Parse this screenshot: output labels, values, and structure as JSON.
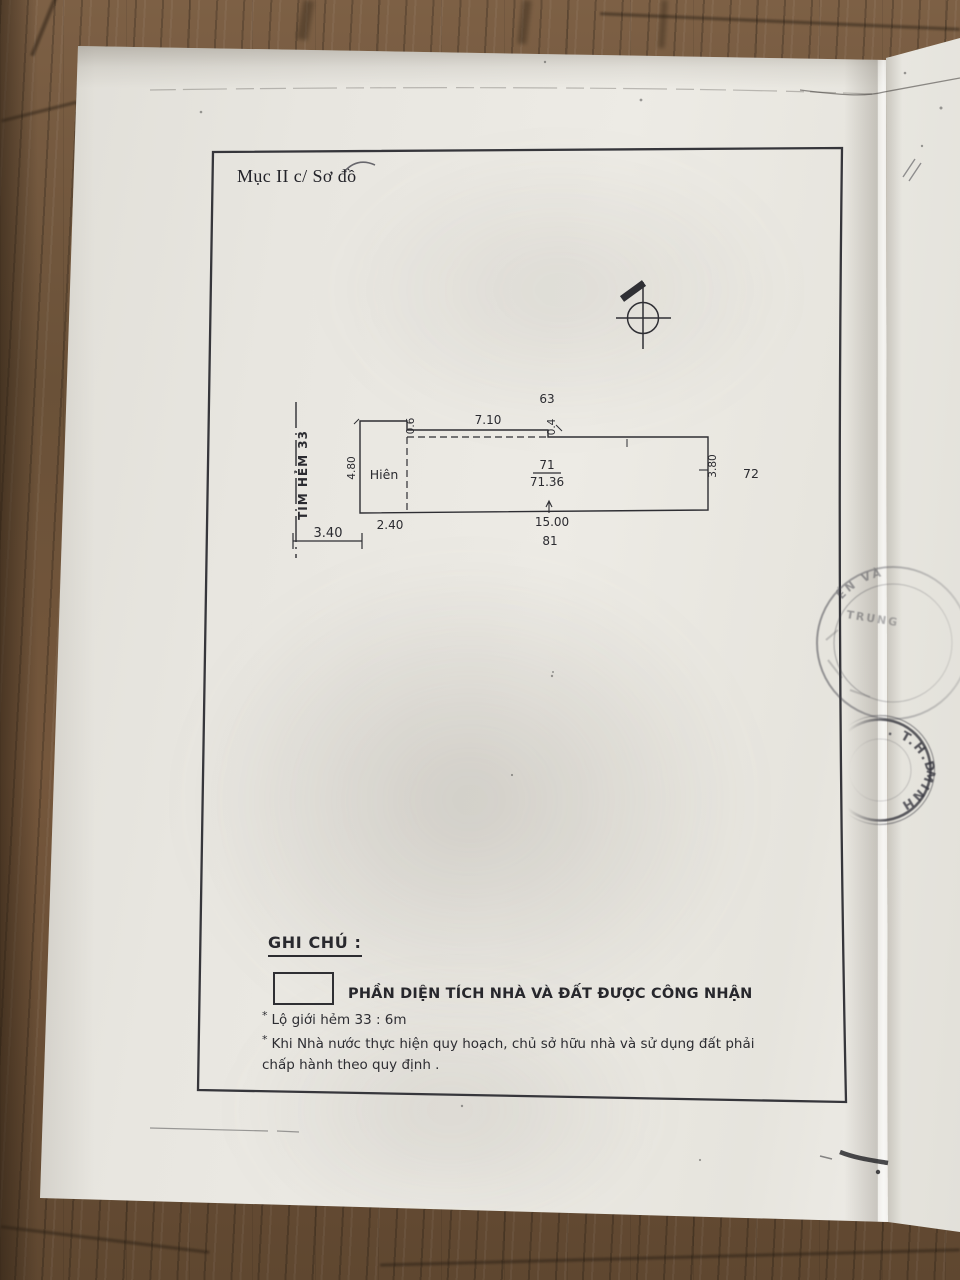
{
  "document": {
    "section_title": "Mục II c/ Sơ đồ",
    "drawing": {
      "alley_centerline_label": "TIM HẺM 33",
      "porch_label": "Hiên",
      "lot_top": "63",
      "lot_right": "72",
      "lot_bottom": "81",
      "area_code": "71",
      "area_value": "71.36",
      "dim_alley_offset": "3.40",
      "dim_porch_width": "2.40",
      "dim_porch_depth": "4.80",
      "dim_step_left": "0.6",
      "dim_canopy": "7.10",
      "dim_step_right": "0.4",
      "dim_length": "15.00",
      "dim_right_depth": "3.80"
    },
    "legend": {
      "heading": "GHI CHÚ :",
      "recognized_label": "PHẦN DIỆN TÍCH NHÀ VÀ ĐẤT ĐƯỢC CÔNG NHẬN",
      "bullet": "*",
      "note_alley": "Lộ giới hẻm 33 : 6m",
      "note_planning": "Khi Nhà nước thực hiện quy hoạch, chủ sở hữu nhà và sử dụng đất phải chấp hành theo quy định ."
    },
    "stamps": {
      "round_stamp_text_top": "ẾN VÀ",
      "round_stamp_text_mid": "TRUNG",
      "edge_stamp_top": ". T.H.D",
      "edge_stamp_bottom": "MINH"
    }
  },
  "colors": {
    "paper": "#e9e7e1",
    "paper_right": "#eae8e2",
    "wood_base": "#74573c",
    "wood_dark": "#4a3724",
    "ink": "#2c2c30",
    "stamp_ink": "#46464e"
  }
}
